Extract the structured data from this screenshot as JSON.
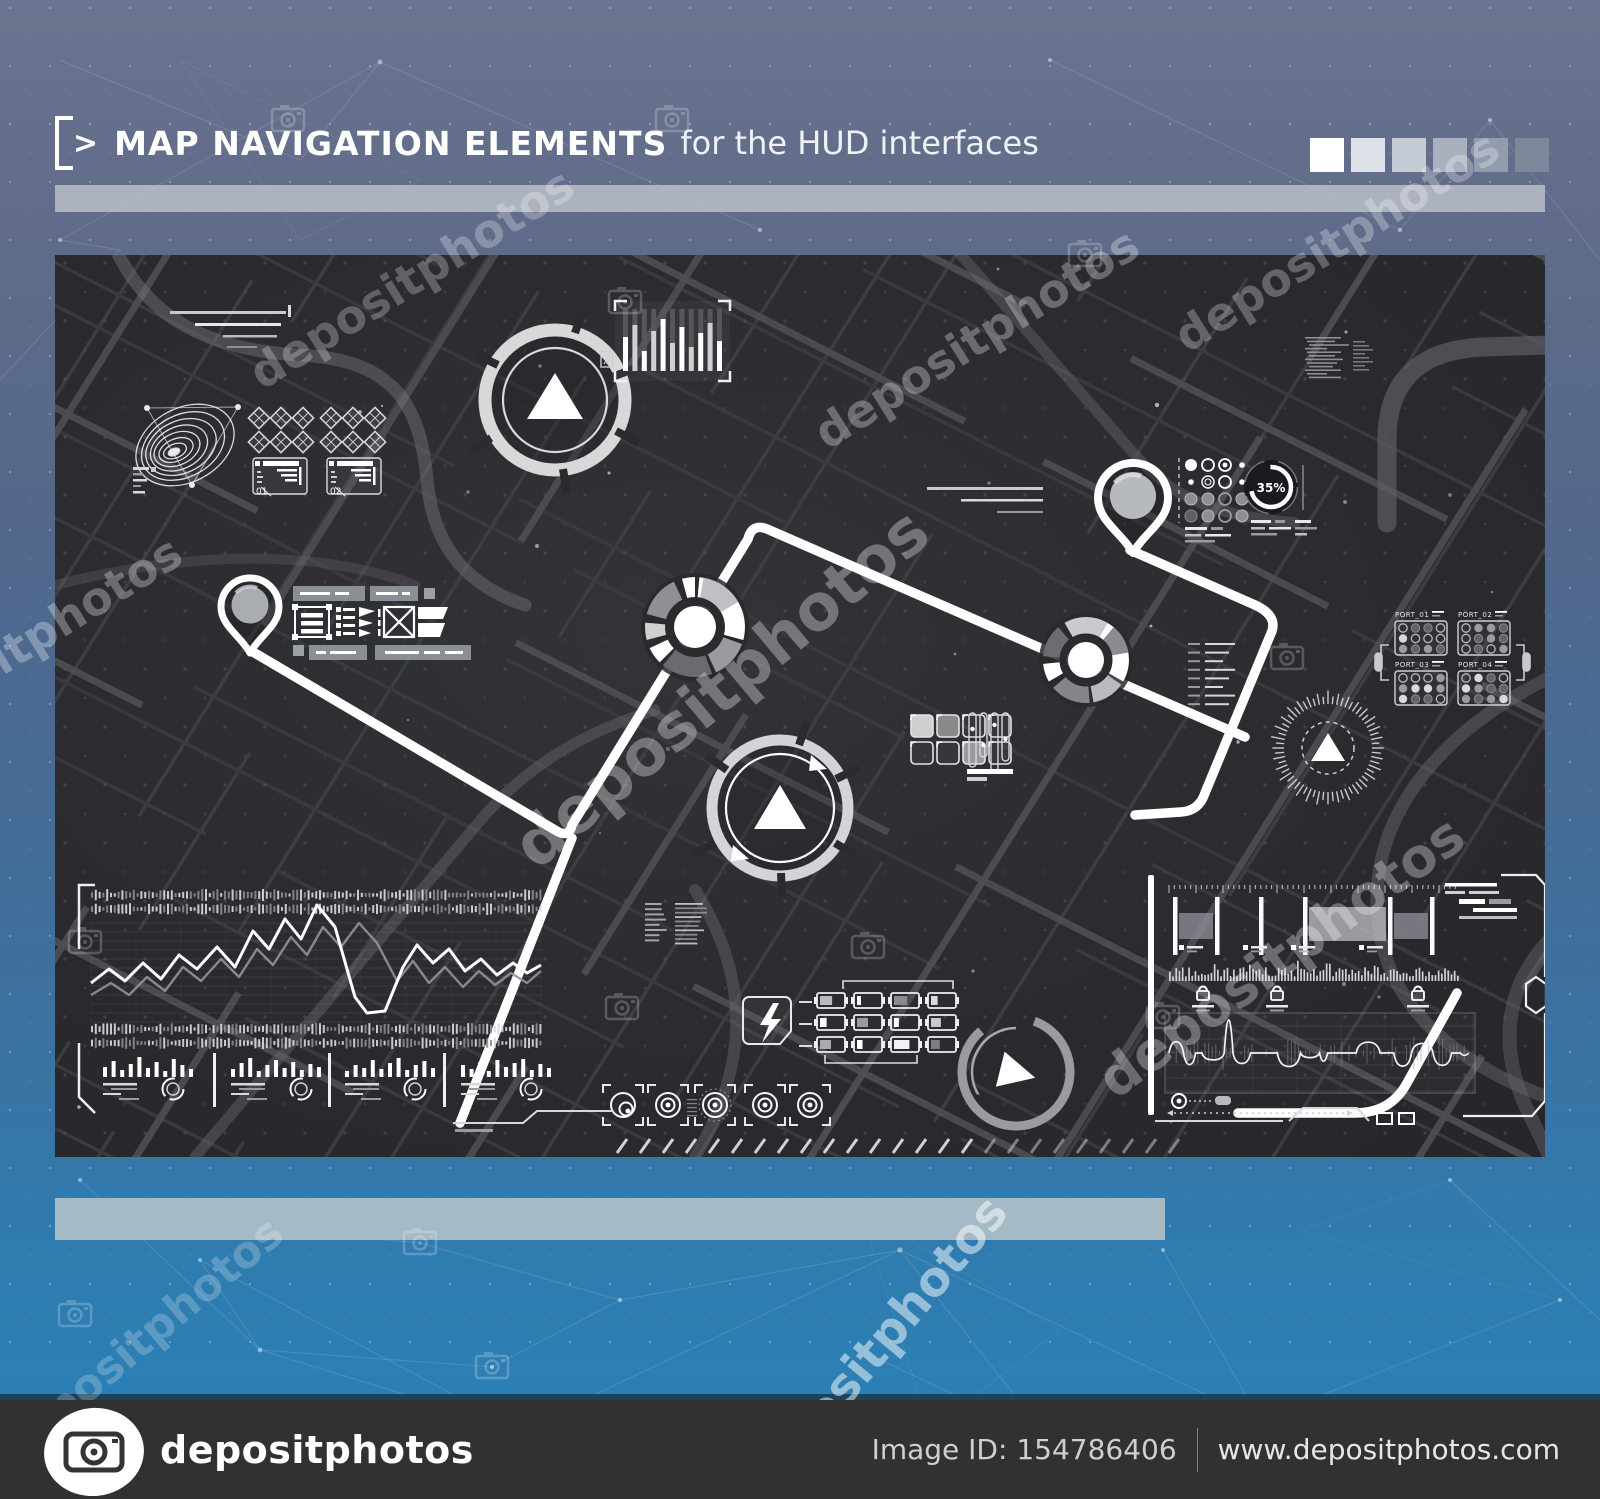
{
  "header": {
    "chevron": ">",
    "title_strong": "MAP NAVIGATION ELEMENTS",
    "title_light": "for the HUD interfaces",
    "palette": [
      "#ffffff",
      "#dde2e8",
      "#c5cbd4",
      "#a9b1bf",
      "#929cad",
      "#7c889b"
    ]
  },
  "map": {
    "panel_labels": [
      "01",
      "02"
    ],
    "gauge_percent": "35%",
    "ports": [
      "PORT_01",
      "PORT_02",
      "PORT_03",
      "PORT_04"
    ]
  },
  "watermark": {
    "text": "depositphotos"
  },
  "footer": {
    "brand": "depositphotos",
    "image_id": "Image ID: 154786406",
    "site": "www.depositphotos.com"
  },
  "colors": {
    "route": "#ffffff",
    "map_bg": "#2b2b2f",
    "bar_gray": "#b3bac3",
    "blue_bottom": "#2a82b8",
    "footer_bg": "#313131"
  }
}
